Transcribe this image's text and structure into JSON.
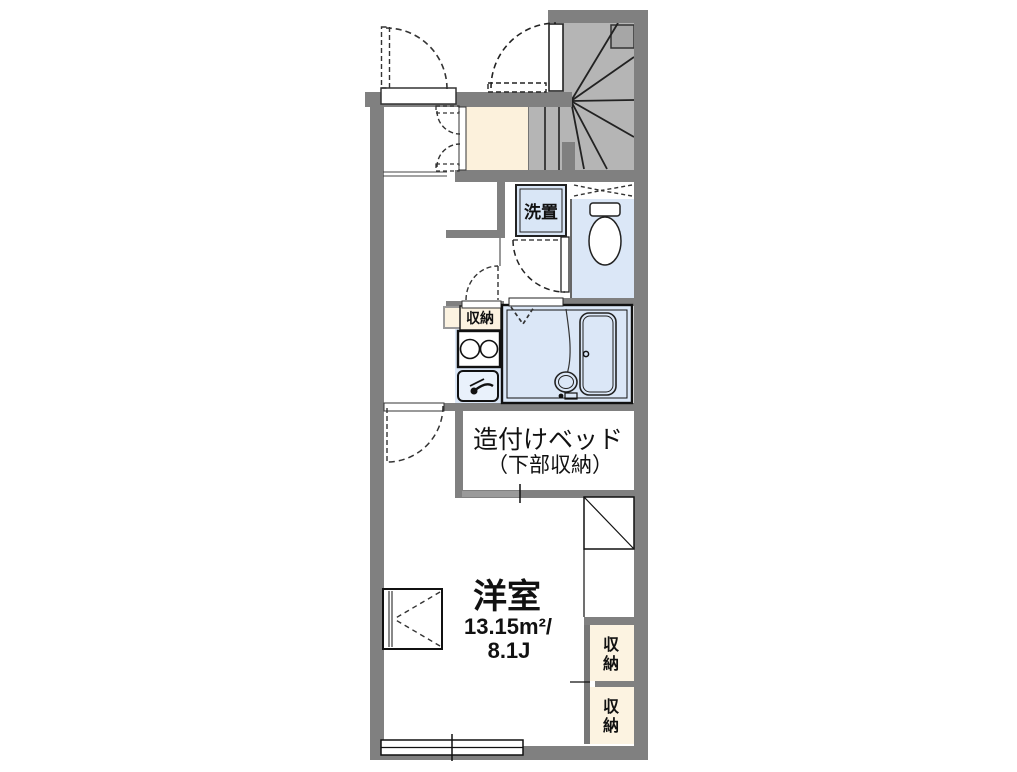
{
  "floor_plan": {
    "labels": {
      "washer_space": "洗置",
      "kitchen_storage": "収納",
      "built_in_bed_line1": "造付けベッド",
      "built_in_bed_line2": "（下部収納）",
      "main_room_name": "洋室",
      "main_room_area_m2": "13.15m²/",
      "main_room_area_jo": "8.1J",
      "storage_upper": {
        "char1": "収",
        "char2": "納"
      },
      "storage_lower": {
        "char1": "収",
        "char2": "納"
      }
    },
    "colors": {
      "wall_gray": "#808080",
      "stair_gray": "#b5b5b5",
      "wet_area_blue": "#dbe7f7",
      "entry_cream": "#fcf1dc",
      "storage_cream": "#fcf3e1",
      "line_black": "#1a1a1a"
    }
  }
}
